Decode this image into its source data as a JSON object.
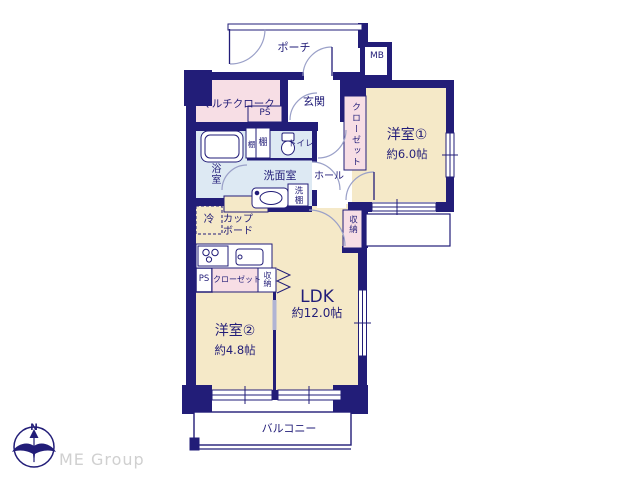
{
  "colors": {
    "wall_navy": "#221d78",
    "room_cream": "#f5e9c8",
    "closet_pink": "#f7dee5",
    "wet_area_blue": "#dde9f3",
    "door_arc_blue": "#9aa0c8",
    "logo_gray": "#d0d0d0"
  },
  "rooms": {
    "porch": "ポーチ",
    "mb": "MB",
    "entrance": "玄関",
    "multi_cloak": "マルチクローク",
    "ps_upper": "PS",
    "closet_1": "クローゼット",
    "western_1": {
      "name": "洋室①",
      "size": "約6.0帖"
    },
    "bath": "浴室",
    "shelf_a": "棚",
    "shelf_b": "棚",
    "toilet": "トイレ",
    "washroom": "洗面室",
    "wash_shelf": "洗棚",
    "hall": "ホール",
    "storage_hall": "収納",
    "fridge": "冷",
    "cupboard": {
      "line1": "カップ",
      "line2": "ボード"
    },
    "ldk": {
      "name": "LDK",
      "size": "約12.0帖"
    },
    "ps_kitchen": "PS",
    "closet_2": "クローゼット",
    "storage_2": "収納",
    "western_2": {
      "name": "洋室②",
      "size": "約4.8帖"
    },
    "balcony": "バルコニー"
  },
  "compass": {
    "north": "N"
  },
  "branding": {
    "logo": "ME Group"
  }
}
